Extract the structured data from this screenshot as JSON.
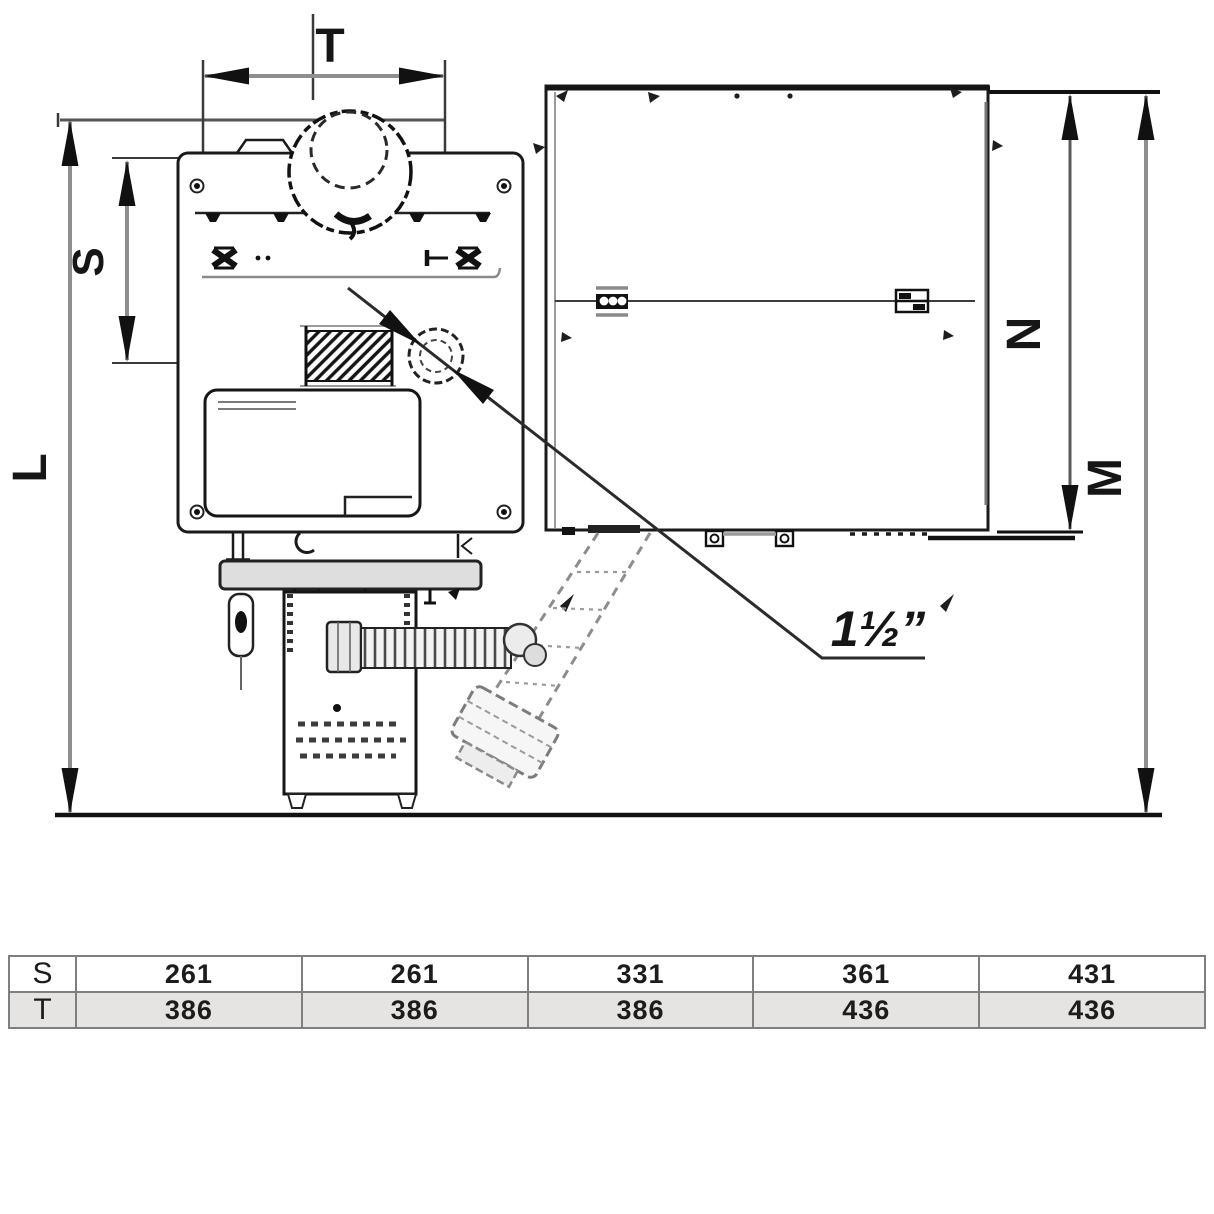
{
  "drawing": {
    "dimension_labels": {
      "T": "T",
      "S": "S",
      "L": "L",
      "N": "N",
      "M": "M"
    },
    "connection_label": "1½”"
  },
  "table": {
    "rows": [
      {
        "label": "S",
        "values": [
          "261",
          "261",
          "331",
          "361",
          "431"
        ]
      },
      {
        "label": "T",
        "values": [
          "386",
          "386",
          "386",
          "436",
          "436"
        ]
      }
    ]
  },
  "colors": {
    "line": "#1a1a1a",
    "dim_line_gray": "#8e8e8e",
    "table_border": "#7f7f7f",
    "table_alt_row": "#e5e4e2"
  }
}
